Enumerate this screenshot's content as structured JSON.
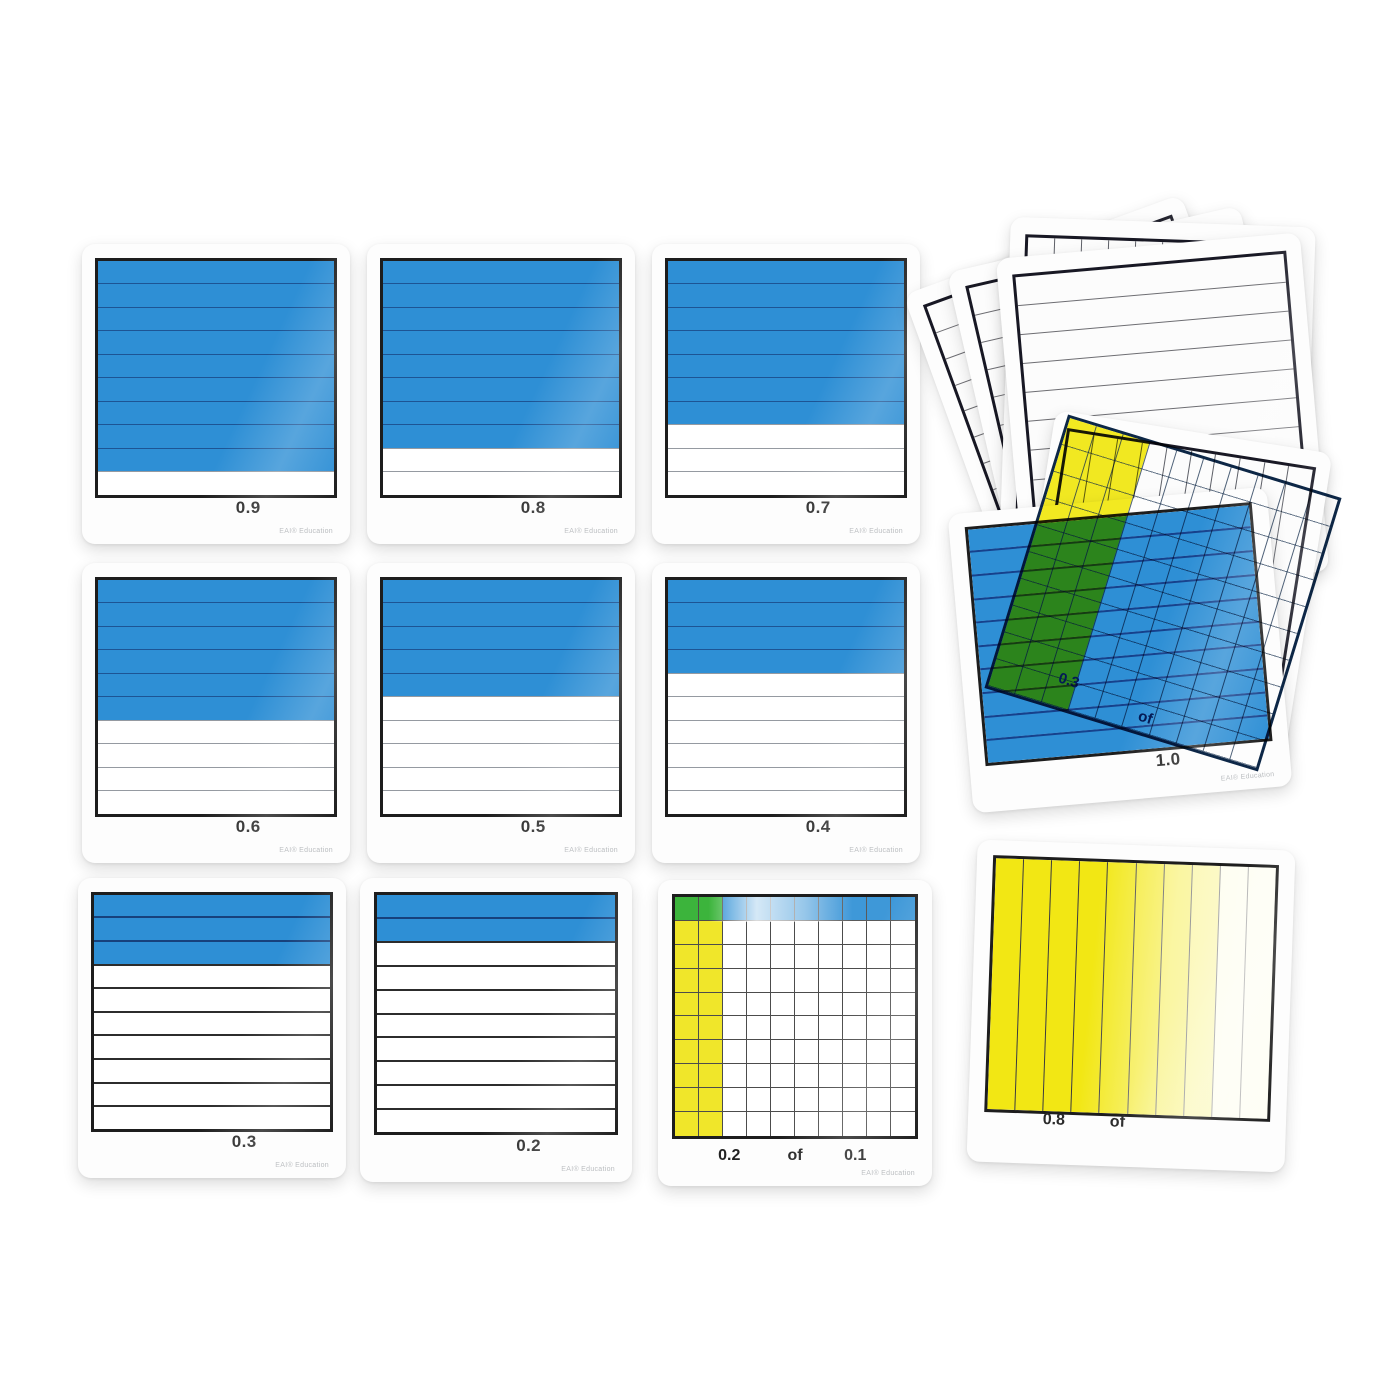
{
  "scene": {
    "description": "Decimal tenths and hundredths demonstration card set",
    "brand": "EAI® Education"
  },
  "colors": {
    "blue": "#2e8fd5",
    "blue_grid_line": "#16418c",
    "yellow": "#f0e62a",
    "green": "#3cb43c",
    "card_frame": "#1d1d1d",
    "overlay_ink": "#132e66"
  },
  "tenths_cards": [
    {
      "label": "0.9",
      "shaded_tenths": 9
    },
    {
      "label": "0.8",
      "shaded_tenths": 8
    },
    {
      "label": "0.7",
      "shaded_tenths": 7
    },
    {
      "label": "0.6",
      "shaded_tenths": 6
    },
    {
      "label": "0.5",
      "shaded_tenths": 5
    },
    {
      "label": "0.4",
      "shaded_tenths": 4
    },
    {
      "label": "0.3",
      "shaded_tenths": 3
    },
    {
      "label": "0.2",
      "shaded_tenths": 2
    }
  ],
  "hundredths_card": {
    "label_left": "0.2",
    "label_mid": "of",
    "label_right": "0.1",
    "yellow_columns": 2,
    "blue_rows": 1,
    "grid_size": 10
  },
  "one_whole_card": {
    "label": "1.0",
    "shaded_tenths": 10
  },
  "overlay_card": {
    "label_left": "0.3",
    "label_mid": "of",
    "yellow_columns": 3,
    "columns": 10
  },
  "yellow_overlay_card": {
    "label_left": "0.8",
    "label_mid": "of",
    "yellow_columns": 8,
    "columns": 10
  },
  "blank_stack": {
    "lined_cards": 3,
    "column_cards": 2
  }
}
